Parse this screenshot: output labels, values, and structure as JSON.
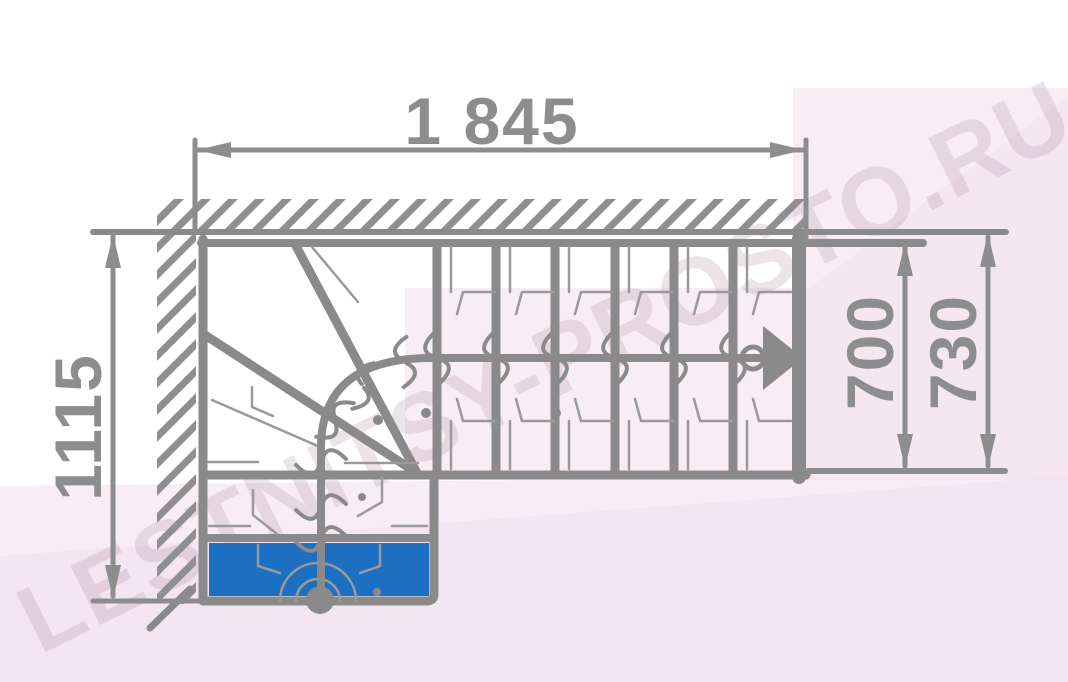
{
  "title": "Staircase floor plan with winder steps",
  "watermark": {
    "text": "LESTNITSY-PROSTO.RU"
  },
  "dimensions": {
    "total_length": "1 845",
    "total_depth": "1115",
    "flight_width_inner": "700",
    "flight_width_outer": "730"
  },
  "colors": {
    "line_gray": "#8a8a8a",
    "thin_gray": "#9a9a9a",
    "dim_gray": "#8d8d8d",
    "first_step_blue": "#1d6fc1",
    "pink_light": "#f8edf4",
    "pink_mid": "#f1e0ec",
    "watermark_tint": "rgba(128,94,118,0.16)"
  }
}
